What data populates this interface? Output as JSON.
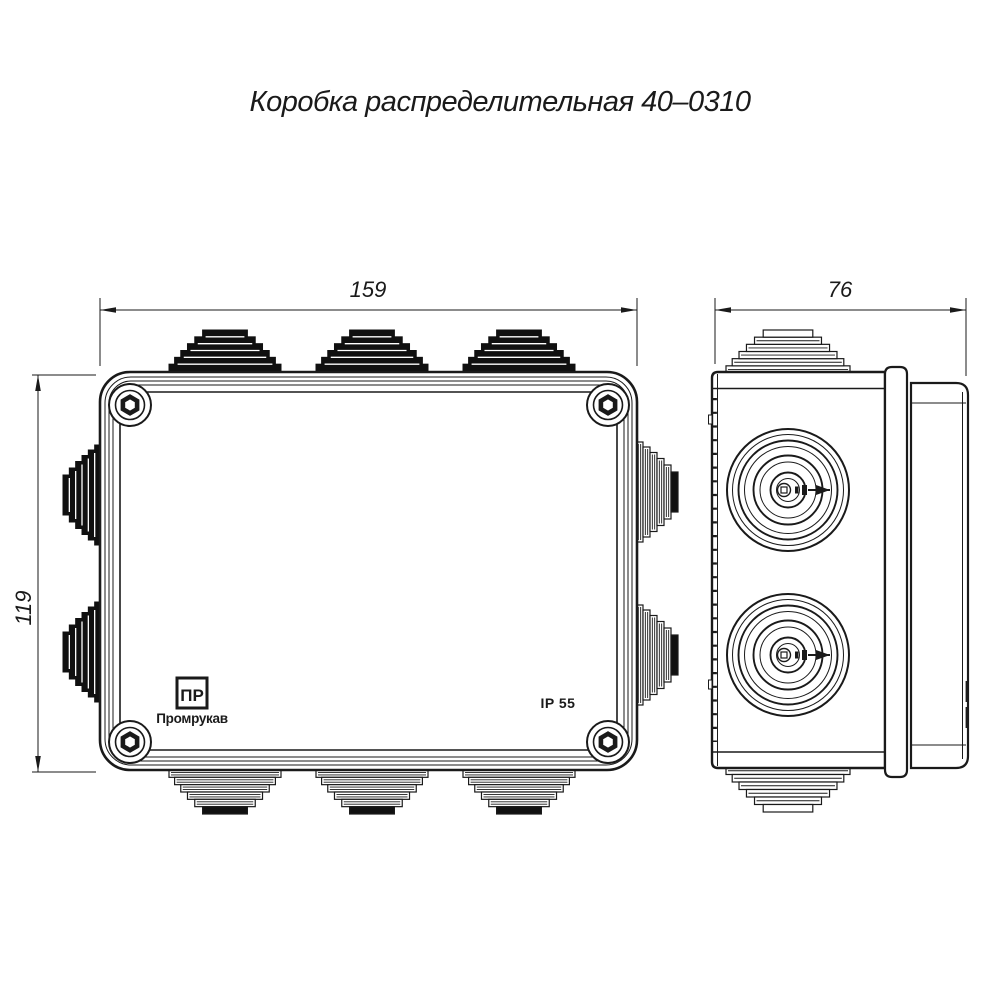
{
  "title": "Коробка распределительная 40–0310",
  "dimensions": {
    "width_mm": "159",
    "height_mm": "119",
    "depth_mm": "76"
  },
  "front_view": {
    "brand": {
      "logo_text": "ПР",
      "name": "Промрукав"
    },
    "ip_rating": "IP 55"
  },
  "colors": {
    "line": "#1a1a1a",
    "background": "#ffffff"
  }
}
